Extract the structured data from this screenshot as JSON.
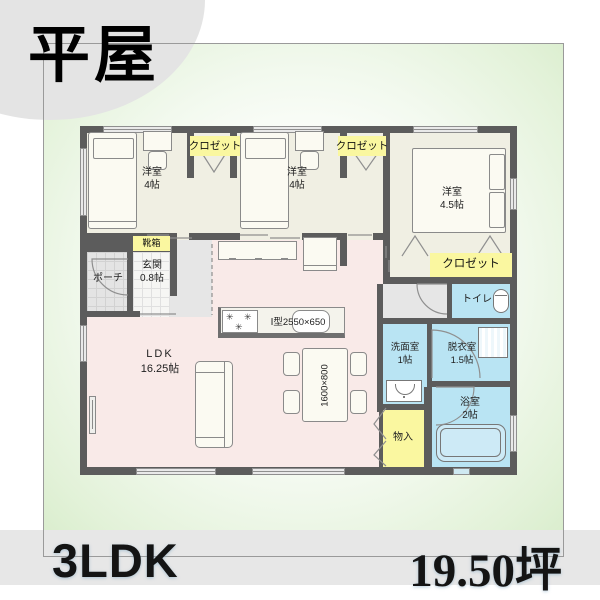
{
  "badge": {
    "label": "平屋"
  },
  "footer": {
    "layout": "3LDK",
    "area": "19.50坪"
  },
  "plan": {
    "bedroom1": {
      "name": "洋室",
      "size": "4帖"
    },
    "bedroom2": {
      "name": "洋室",
      "size": "4帖"
    },
    "bedroom3": {
      "name": "洋室",
      "size": "4.5帖"
    },
    "closet1": {
      "label": "クロゼット"
    },
    "closet2": {
      "label": "クロゼット"
    },
    "closet3": {
      "label": "クロゼット"
    },
    "shoebox": {
      "label": "靴箱"
    },
    "porch": {
      "label": "ポーチ"
    },
    "entrance": {
      "name": "玄関",
      "size": "0.8帖"
    },
    "ldk": {
      "name": "LDK",
      "size": "16.25帖"
    },
    "kitchen": {
      "label": "Ⅰ型2550×650"
    },
    "dining_table": {
      "label": "1600×800"
    },
    "toilet": {
      "label": "トイレ"
    },
    "washroom": {
      "name": "洗面室",
      "size": "1帖"
    },
    "dressing": {
      "name": "脱衣室",
      "size": "1.5帖"
    },
    "bath": {
      "name": "浴室",
      "size": "2帖"
    },
    "storage": {
      "label": "物入"
    }
  },
  "colors": {
    "wall": "#5c5c5c",
    "bedroom_floor": "#f0efe3",
    "ldk_floor": "#f9eae8",
    "wet_room_floor": "#b9e4f3",
    "closet_label": "#faf7a0",
    "porch_floor": "#e4e4e4",
    "green_tint": "#d7ecca",
    "footer_band": "#e7e7e7",
    "badge_circle": "#e4e4e4"
  }
}
